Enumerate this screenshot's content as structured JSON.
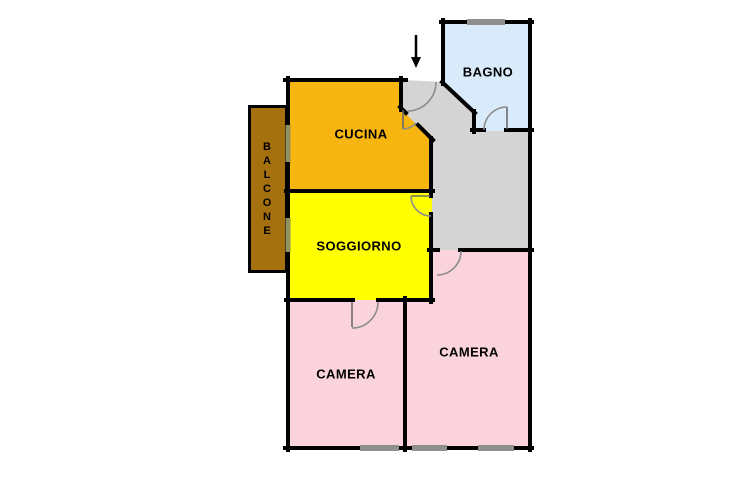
{
  "plan": {
    "type": "apartment-floor-plan",
    "rooms": [
      {
        "id": "cucina",
        "name": "CUCINA",
        "color": "#F6B60F"
      },
      {
        "id": "soggiorno",
        "name": "SOGGIORNO",
        "color": "#FFFF00"
      },
      {
        "id": "bagno",
        "name": "BAGNO",
        "color": "#D9EAFA"
      },
      {
        "id": "camera-left",
        "name": "CAMERA",
        "color": "#FAD3DC"
      },
      {
        "id": "camera-right",
        "name": "CAMERA",
        "color": "#FAD3DC"
      },
      {
        "id": "balcone",
        "name": "BALCONE",
        "color": "#A5700E"
      }
    ],
    "hallway": {
      "color": "#D4D4D4"
    },
    "structure": {
      "wall_color": "#000000",
      "window_color": "#8F8F8F",
      "balcony_opening_color": "#93905F",
      "door_arc_color": "#8C8C8C",
      "door_leaf_color": "#6B6B6B",
      "background": "#FFFFFF"
    },
    "icons": {
      "entrance_arrow": "down-arrow"
    }
  }
}
